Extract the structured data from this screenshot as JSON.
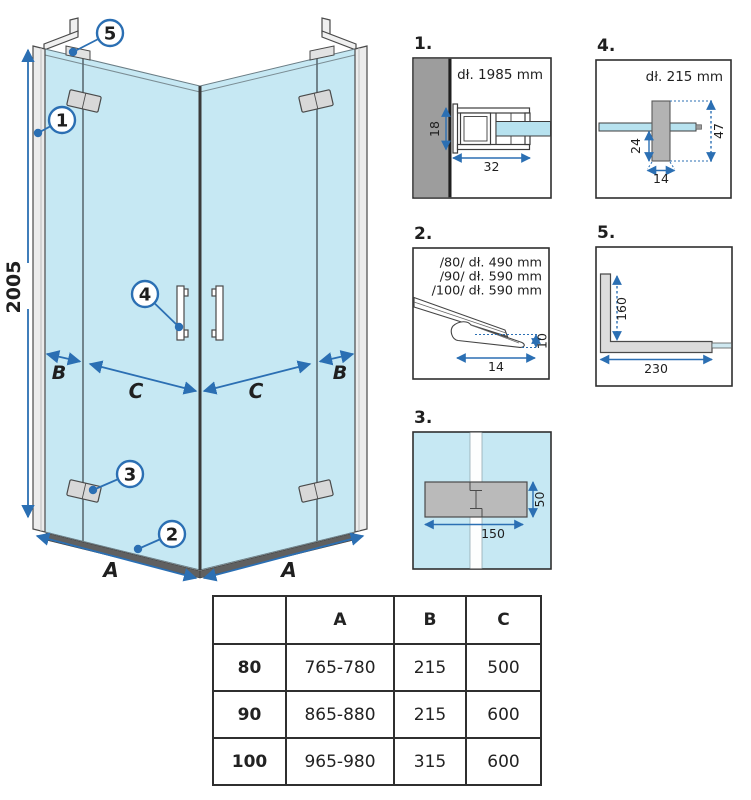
{
  "colors": {
    "accent_blue": "#2b6fb3",
    "glass_blue": "#c6e8f3",
    "glass_edge_blue": "#b7e2ef",
    "wall_gray": "#9d9d9d",
    "profile_gray": "#b3b3b3",
    "bracket_gray": "#dcdcdc",
    "line_dark": "#2f2f2f"
  },
  "main_drawing": {
    "height_dim": "2005",
    "dim_a": "A",
    "dim_b": "B",
    "dim_c": "C",
    "callouts": [
      "1",
      "2",
      "3",
      "4",
      "5"
    ]
  },
  "details": [
    {
      "num": "1.",
      "title": "dł. 1985 mm",
      "dim_height": "18",
      "dim_width": "32"
    },
    {
      "num": "2.",
      "lines": [
        "/80/ dł. 490 mm",
        "/90/ dł. 590 mm",
        "/100/ dł. 590 mm"
      ],
      "dim_height": "10",
      "dim_width": "14"
    },
    {
      "num": "3.",
      "dim_width": "150",
      "dim_height": "50"
    },
    {
      "num": "4.",
      "title": "dł. 215 mm",
      "dim_offset": "24",
      "dim_height": "47",
      "dim_width": "14"
    },
    {
      "num": "5.",
      "dim_height": "160",
      "dim_width": "230"
    }
  ],
  "table": {
    "headers": [
      "",
      "A",
      "B",
      "C"
    ],
    "rows": [
      [
        "80",
        "765-780",
        "215",
        "500"
      ],
      [
        "90",
        "865-880",
        "215",
        "600"
      ],
      [
        "100",
        "965-980",
        "315",
        "600"
      ]
    ]
  }
}
